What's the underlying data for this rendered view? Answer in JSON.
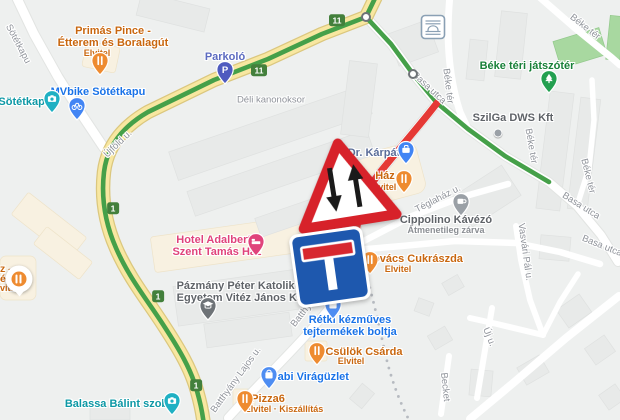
{
  "map_type": "road-map",
  "colors": {
    "background": "#eef0ef",
    "road_yellow": "#f8e7a1",
    "road_yellow_casing": "#dbc77e",
    "building": "#e8eae9",
    "commercial_area": "#f8f1e1",
    "park_green": "#a8d8a0",
    "route_green": "#45a049",
    "route_red": "#e53935",
    "badge_green": "#43803c",
    "street_label": "#8f939a",
    "dead_end_sign_blue": "#1e58ae",
    "sign_red": "#d7282f"
  },
  "signs": {
    "warning": {
      "type": "two-way-traffic-warning-sign",
      "x": 344,
      "y": 183,
      "rot": -9
    },
    "dead_end": {
      "type": "no-through-road-sign",
      "x": 330,
      "y": 267,
      "rot": -8
    }
  },
  "route_badges": [
    {
      "label": "11",
      "x": 337,
      "y": 20
    },
    {
      "label": "11",
      "x": 259,
      "y": 70
    },
    {
      "label": "1",
      "x": 113,
      "y": 208
    },
    {
      "label": "1",
      "x": 158,
      "y": 296
    },
    {
      "label": "1",
      "x": 196,
      "y": 385
    }
  ],
  "waypoints": [
    {
      "x": 366,
      "y": 17
    },
    {
      "x": 413,
      "y": 74
    }
  ],
  "tunnel_icon": {
    "x": 433,
    "y": 27
  },
  "street_labels": [
    {
      "text": "Sötétkapu",
      "x": 18,
      "y": 44,
      "rot": 62
    },
    {
      "text": "Újföld u.",
      "x": 118,
      "y": 144,
      "rot": -44
    },
    {
      "text": "Déli kanonoksor",
      "x": 271,
      "y": 100,
      "rot": 0
    },
    {
      "text": "Basa utca",
      "x": 429,
      "y": 88,
      "rot": 43
    },
    {
      "text": "Basa utca",
      "x": 581,
      "y": 206,
      "rot": 32
    },
    {
      "text": "Basa utca",
      "x": 602,
      "y": 246,
      "rot": 22
    },
    {
      "text": "Béke tér",
      "x": 448,
      "y": 86,
      "rot": 83
    },
    {
      "text": "Béke tér",
      "x": 585,
      "y": 27,
      "rot": 38
    },
    {
      "text": "Béke tér",
      "x": 531,
      "y": 146,
      "rot": 80
    },
    {
      "text": "Béke tér",
      "x": 588,
      "y": 176,
      "rot": 76
    },
    {
      "text": "Téglaház u.",
      "x": 438,
      "y": 199,
      "rot": -27
    },
    {
      "text": "Vasvári Pál u.",
      "x": 525,
      "y": 252,
      "rot": 82
    },
    {
      "text": "Új u.",
      "x": 489,
      "y": 337,
      "rot": 68
    },
    {
      "text": "Becket",
      "x": 445,
      "y": 387,
      "rot": 84
    },
    {
      "text": "Batthyány Lajos u.",
      "x": 317,
      "y": 295,
      "rot": -52
    },
    {
      "text": "Batthyány Lajos u.",
      "x": 236,
      "y": 380,
      "rot": -54
    }
  ],
  "pois": [
    {
      "id": "primas-pince",
      "name": "Primás Pince -\nÉtterem és Boralagút",
      "sub": "Elvitel",
      "color": "#c9670f",
      "icon": "restaurant",
      "pin_color": "#ee8b30",
      "pin_x": 100,
      "pin_y": 62,
      "label_x": 113,
      "label_y": 37,
      "sub_x": 97,
      "sub_y": 53
    },
    {
      "id": "sotetkapu-poi",
      "name": "Sötétkapu",
      "color": "#0d98a5",
      "icon": "camera",
      "pin_color": "#1fb0c3",
      "pin_x": 52,
      "pin_y": 100,
      "label_x": 25,
      "label_y": 102
    },
    {
      "id": "mvbike-sotetkapu",
      "name": "MVbike Sötétkapu",
      "color": "#1a73e8",
      "icon": "bike",
      "pin_color": "#4285f4",
      "pin_x": 77,
      "pin_y": 107,
      "label_x": 98,
      "label_y": 92
    },
    {
      "id": "parkolo",
      "name": "Parkoló",
      "color": "#5c6bc0",
      "icon": "parking",
      "pin_color": "#4f5bbf",
      "pin_x": 225,
      "pin_y": 71,
      "label_x": 225,
      "label_y": 57
    },
    {
      "id": "dr-karpat",
      "name": "Dr. Kárpát",
      "color": "#5b6d99",
      "icon": "briefcase",
      "pin_color": "#4285f4",
      "pin_x": 406,
      "pin_y": 151,
      "label_x": 374,
      "label_y": 153
    },
    {
      "id": "haz",
      "name": "Ház",
      "sub": "Elvitel",
      "color": "#c9670f",
      "icon": "restaurant",
      "pin_color": "#ee8b30",
      "pin_x": 404,
      "pin_y": 180,
      "label_x": 385,
      "label_y": 176,
      "sub_x": 383,
      "sub_y": 187
    },
    {
      "id": "cippolino-kavezo",
      "name": "Cippolino Kávézó",
      "sub": "Átmenetileg zárva",
      "color": "#5f6368",
      "sub_color": "#8a8e93",
      "icon": "cafe",
      "pin_color": "#9aa0a6",
      "pin_x": 461,
      "pin_y": 203,
      "label_x": 446,
      "label_y": 220,
      "sub_x": 446,
      "sub_y": 230
    },
    {
      "id": "szilga-dws-kft",
      "name": "SzilGa DWS Kft",
      "color": "#5f6368",
      "icon": "dot",
      "pin_color": "#9aa0a6",
      "pin_x": 498,
      "pin_y": 133,
      "label_x": 513,
      "label_y": 118
    },
    {
      "id": "beke-teri-jatszoter",
      "name": "Béke téri játszótér",
      "color": "#188038",
      "icon": "tree",
      "pin_color": "#23a050",
      "pin_x": 549,
      "pin_y": 80,
      "label_x": 527,
      "label_y": 66
    },
    {
      "id": "kovacs-cukraszda",
      "name": "Kovács Cukrászda",
      "sub": "Elvitel",
      "color": "#c9670f",
      "icon": "restaurant",
      "pin_color": "#ee8b30",
      "pin_x": 370,
      "pin_y": 261,
      "label_x": 414,
      "label_y": 259,
      "sub_x": 398,
      "sub_y": 269
    },
    {
      "id": "retki-kezmuves-bolt",
      "name": "Rétki kézműves\ntejtermékek boltja",
      "color": "#1a73e8",
      "icon": "shopping",
      "pin_color": "#4e8df2",
      "pin_x": 333,
      "pin_y": 306,
      "label_x": 350,
      "label_y": 326
    },
    {
      "id": "csulok-csarda",
      "name": "Csülök Csárda",
      "sub": "Elvitel",
      "color": "#c9670f",
      "icon": "restaurant",
      "pin_color": "#ee8b30",
      "pin_x": 317,
      "pin_y": 352,
      "label_x": 364,
      "label_y": 352,
      "sub_x": 351,
      "sub_y": 361
    },
    {
      "id": "gabi-viraguzlet",
      "name": "Gabi Virágüzlet",
      "color": "#1a73e8",
      "icon": "shopping",
      "pin_color": "#4e8df2",
      "pin_x": 269,
      "pin_y": 376,
      "label_x": 309,
      "label_y": 377
    },
    {
      "id": "pizza6",
      "name": "Pizza6",
      "sub": "Elvitel · Kiszállítás",
      "color": "#c9670f",
      "icon": "restaurant",
      "pin_color": "#ee8b30",
      "pin_x": 245,
      "pin_y": 400,
      "label_x": 268,
      "label_y": 399,
      "sub_x": 284,
      "sub_y": 409
    },
    {
      "id": "balassa-balint-szobor",
      "name": "Balassa Bálint szobor",
      "color": "#0d98a5",
      "icon": "camera",
      "pin_color": "#1fb0c3",
      "pin_x": 172,
      "pin_y": 402,
      "label_x": 122,
      "label_y": 404
    },
    {
      "id": "hotel-adalbert",
      "name": "Hotel Adalbert -\nSzent Tamás Ház",
      "color": "#e0437b",
      "icon": "hotel",
      "pin_color": "#e0437b",
      "pin_x": 256,
      "pin_y": 243,
      "label_x": 217,
      "label_y": 246
    },
    {
      "id": "pazmany-egyetem",
      "name": "Pázmány Péter Katolikus\nEgyetem Vitéz János Kar",
      "color": "#5f6368",
      "icon": "school",
      "pin_color": "#6e7377",
      "pin_x": 208,
      "pin_y": 307,
      "label_x": 242,
      "label_y": 292
    }
  ],
  "partial_poi": {
    "lines": [
      "z -",
      "éző",
      "vitel"
    ],
    "color": "#c9670f",
    "balloon_x": 19,
    "balloon_y": 279
  }
}
